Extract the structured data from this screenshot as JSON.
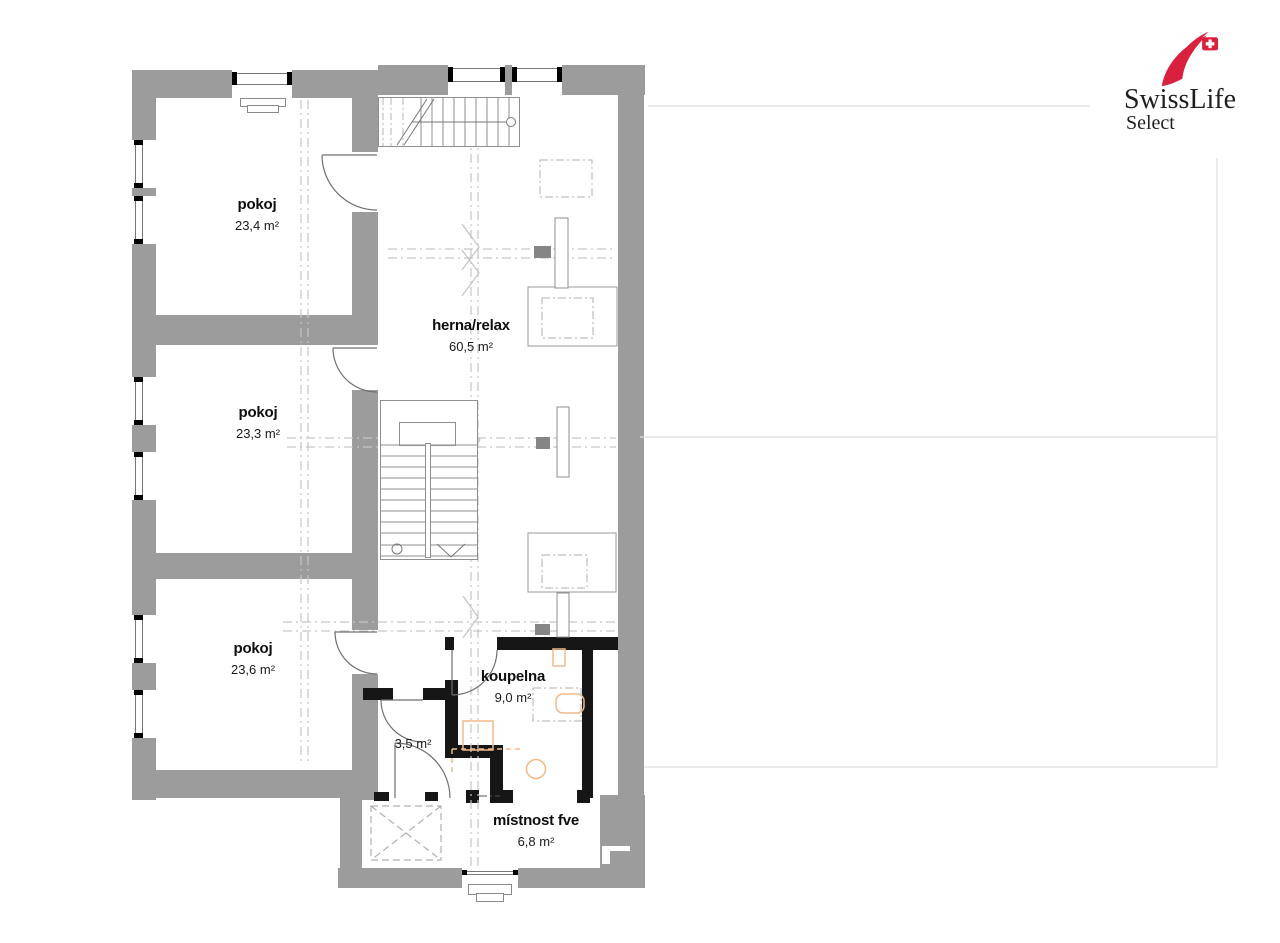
{
  "logo": {
    "brand": "SwissLife",
    "sub": "Select"
  },
  "rooms": [
    {
      "name": "pokoj",
      "area": "23,4 m²"
    },
    {
      "name": "pokoj",
      "area": "23,3 m²"
    },
    {
      "name": "pokoj",
      "area": "23,6 m²"
    },
    {
      "name": "herna/relax",
      "area": "60,5 m²"
    },
    {
      "name": "koupelna",
      "area": "9,0 m²"
    },
    {
      "name": "",
      "area": "3,5 m²"
    },
    {
      "name": "místnost fve",
      "area": "6,8 m²"
    }
  ],
  "colors": {
    "wall_gray": "#9c9c9c",
    "new_partition_black": "#161616",
    "fixture_orange": "#f0b98a",
    "logo_red": "#d9213f",
    "linework_gray": "#8f8f8f"
  }
}
